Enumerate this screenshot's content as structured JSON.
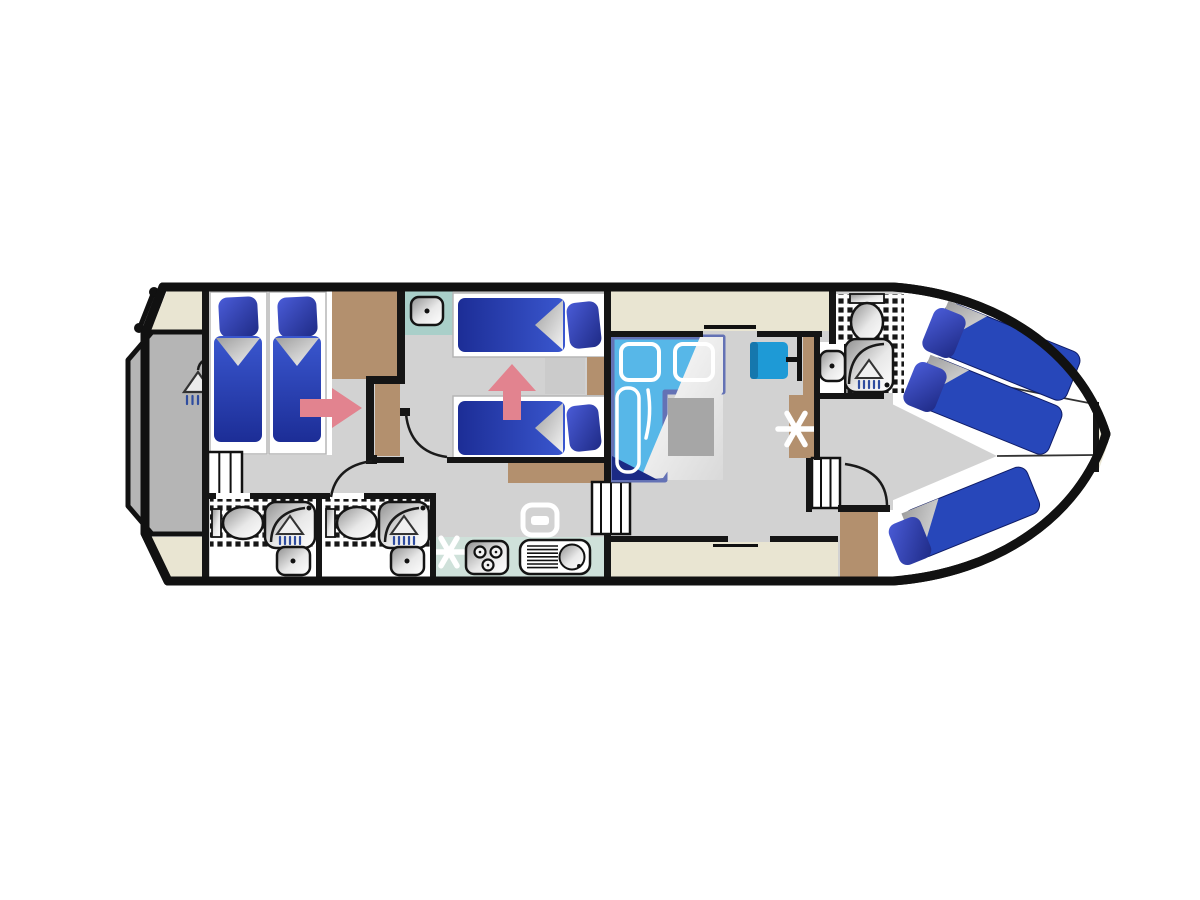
{
  "canvas": {
    "width": 1200,
    "height": 900
  },
  "colors": {
    "wall": "#151515",
    "hull": "#111111",
    "floor": "#d2d2d2",
    "platform": "#b5b5b5",
    "deck": "#e9e5d2",
    "wood": "#b3906e",
    "counter": "#cfe1da",
    "teal_tile": "#a9cfc9",
    "bed_blue": "#2747ba",
    "navy": "#1b2a85",
    "sofa_blue": "#57b7e8",
    "sofa_border": "#6472b5",
    "chair_blue": "#1e9ad6",
    "arrow_pink": "#e2838f",
    "table_gray": "#a6a6a6",
    "spray_blue": "#2f4da0"
  },
  "boat": {
    "type": "houseboat-floorplan",
    "orientation": "bow-right",
    "rooms": [
      {
        "name": "stern-swim-platform",
        "features": [
          "deck-shower",
          "flag-pole"
        ]
      },
      {
        "name": "aft-cabin",
        "features": [
          "two-single-beds",
          "wardrobe",
          "entry-steps",
          "door-arrow"
        ]
      },
      {
        "name": "bathroom-aft-1",
        "features": [
          "toilet",
          "shower",
          "washbasin"
        ]
      },
      {
        "name": "bathroom-aft-2",
        "features": [
          "toilet",
          "shower",
          "washbasin"
        ]
      },
      {
        "name": "mid-cabin",
        "features": [
          "two-single-beds",
          "washbasin",
          "wardrobe",
          "door-arrow"
        ]
      },
      {
        "name": "galley",
        "features": [
          "three-burner-hob",
          "sink-with-drainer",
          "oven",
          "steps"
        ]
      },
      {
        "name": "saloon",
        "features": [
          "l-shaped-convertible-sofa",
          "table",
          "helm-seat",
          "steering-position"
        ]
      },
      {
        "name": "bathroom-bow",
        "features": [
          "toilet",
          "shower",
          "washbasin"
        ]
      },
      {
        "name": "bow-cabin",
        "features": [
          "double-bed",
          "single-bed",
          "wardrobe",
          "steps"
        ]
      }
    ]
  }
}
